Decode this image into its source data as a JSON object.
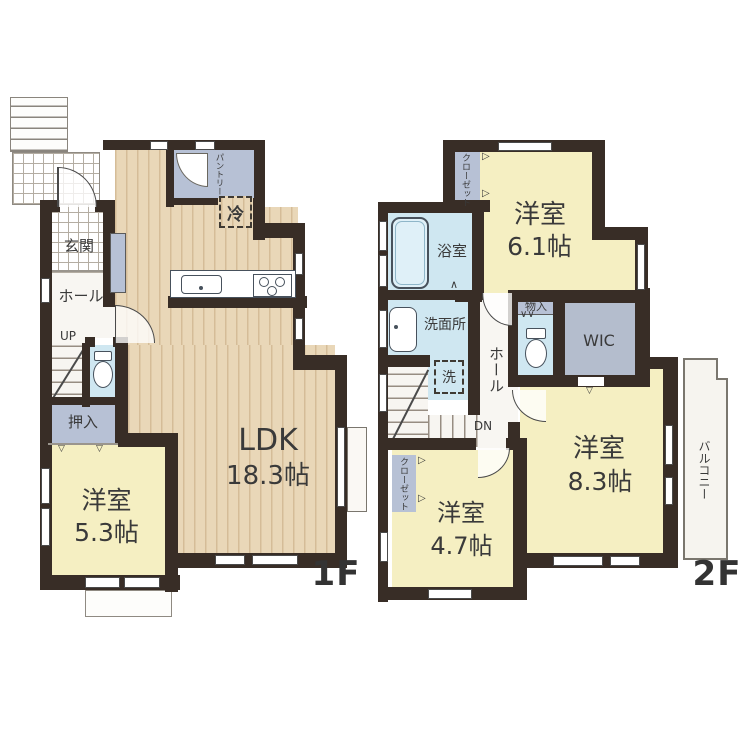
{
  "colors": {
    "wall": "#382d26",
    "ldk_floor": "#e9d7b8",
    "western_room_floor": "#f5efc2",
    "water_area": "#cfe7f1",
    "storage": "#b7c1d5",
    "wic": "#b4bdcd",
    "text": "#3a3a3a"
  },
  "floor1": {
    "label": "1F",
    "ldk_name": "LDK",
    "ldk_size": "18.3帖",
    "room53_name": "洋室",
    "room53_size": "5.3帖",
    "genkan": "玄関",
    "hall": "ホール",
    "up": "UP",
    "oshiire": "押入",
    "pantry": "パントリー",
    "fridge": "冷"
  },
  "floor2": {
    "label": "2F",
    "room61_name": "洋室",
    "room61_size": "6.1帖",
    "room83_name": "洋室",
    "room83_size": "8.3帖",
    "room47_name": "洋室",
    "room47_size": "4.7帖",
    "closet_a": "クローゼット",
    "closet_b": "クローゼット",
    "bath": "浴室",
    "washroom": "洗面所",
    "washer": "洗",
    "hall": "ホール",
    "down": "DN",
    "storage": "物入",
    "wic": "WIC",
    "balcony": "バルコニー"
  }
}
